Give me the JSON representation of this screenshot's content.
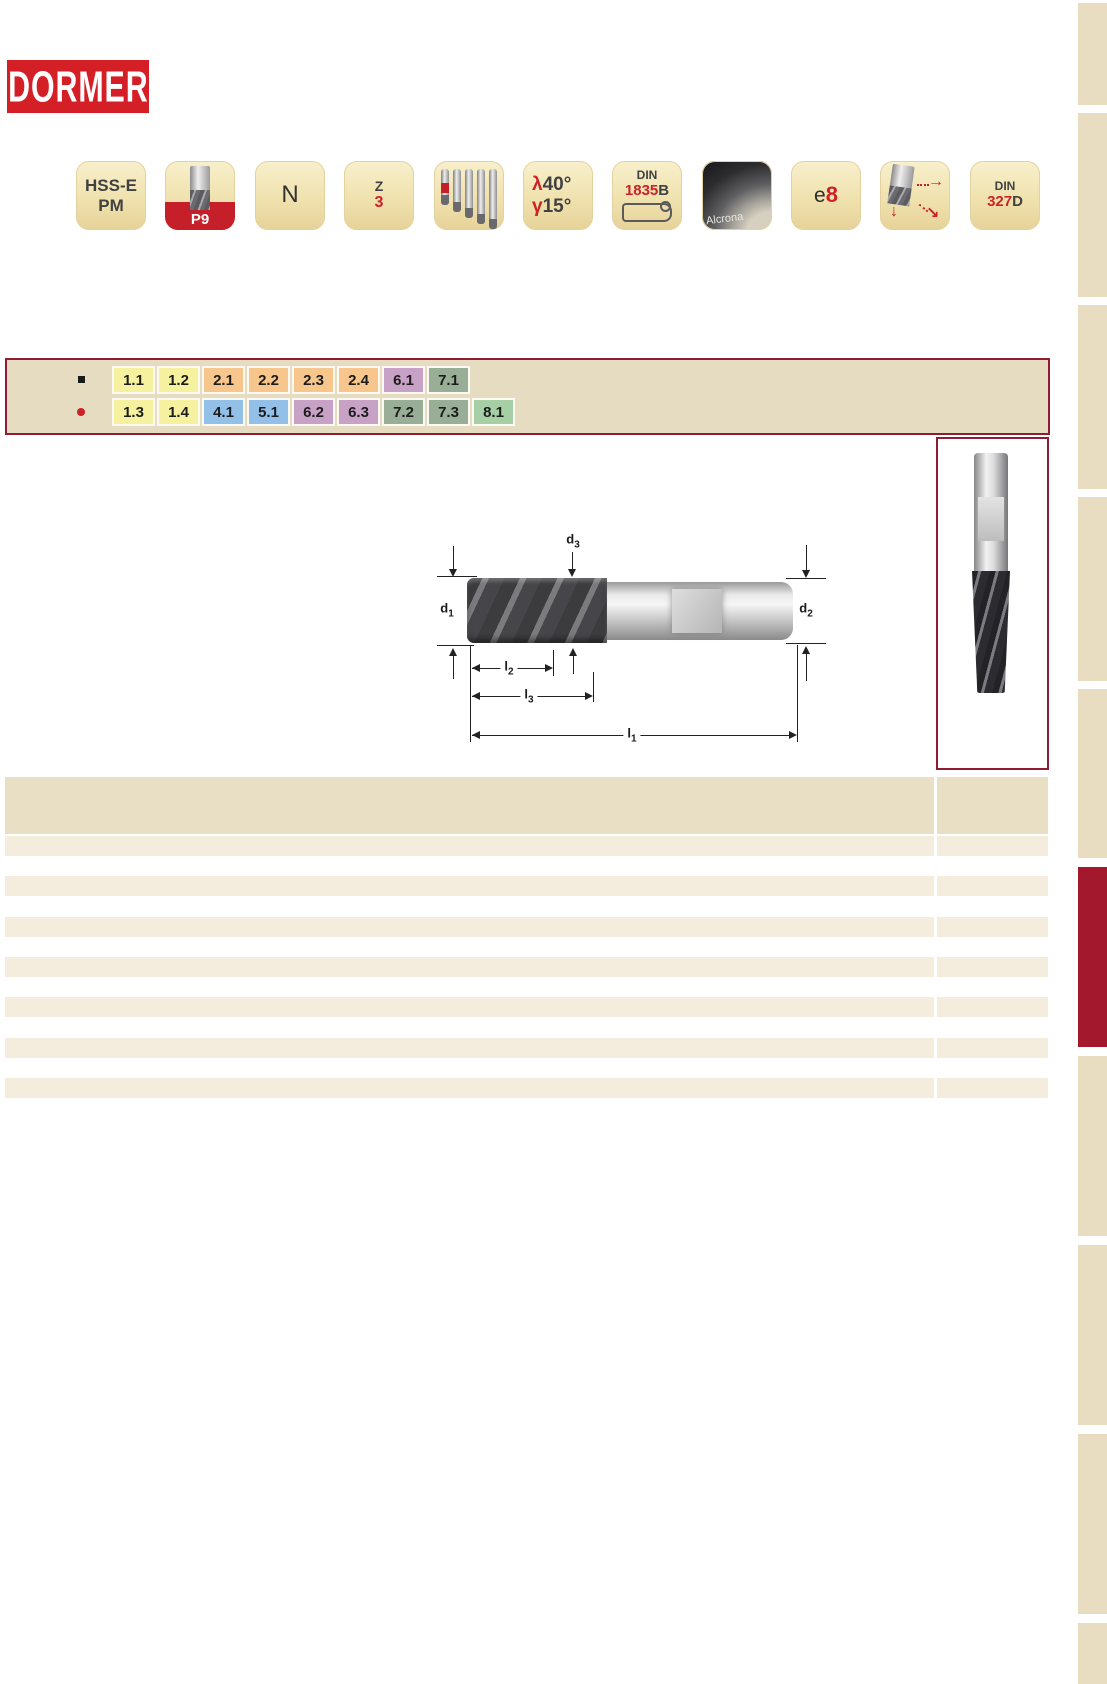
{
  "logo": {
    "text": "DORMER",
    "bg": "#d51f27",
    "fg": "#ffffff"
  },
  "badges": [
    {
      "name": "material-badge",
      "line1": "HSS-E",
      "line2": "PM"
    },
    {
      "name": "application-group-badge",
      "label": "P9"
    },
    {
      "name": "iso-material-badge",
      "label": "N"
    },
    {
      "name": "flute-count-badge",
      "symbol": "Z",
      "value": "3"
    },
    {
      "name": "product-range-badge"
    },
    {
      "name": "geometry-badge",
      "helix_symbol": "λ",
      "helix_value": "40°",
      "rake_symbol": "γ",
      "rake_value": "15°"
    },
    {
      "name": "shank-standard-badge",
      "std": "DIN",
      "num": "1835",
      "suffix": "B"
    },
    {
      "name": "coating-badge",
      "label": "Alcrona"
    },
    {
      "name": "tolerance-badge",
      "prefix": "e",
      "value": "8"
    },
    {
      "name": "ramping-badge",
      "arrow_right": "→",
      "arrow_down": "↓",
      "arrow_diag": "↘"
    },
    {
      "name": "standard-badge",
      "std": "DIN",
      "num": "327",
      "suffix": "D"
    }
  ],
  "codes": {
    "row1": {
      "bullet": "black-square",
      "items": [
        {
          "label": "1.1",
          "bg": "#f6f19e"
        },
        {
          "label": "1.2",
          "bg": "#f6f19e"
        },
        {
          "label": "2.1",
          "bg": "#f6c68c"
        },
        {
          "label": "2.2",
          "bg": "#f6c68c"
        },
        {
          "label": "2.3",
          "bg": "#f6c68c"
        },
        {
          "label": "2.4",
          "bg": "#f6c68c"
        },
        {
          "label": "6.1",
          "bg": "#c8a2c6"
        },
        {
          "label": "7.1",
          "bg": "#99ae97"
        }
      ]
    },
    "row2": {
      "bullet": "red-dot",
      "items": [
        {
          "label": "1.3",
          "bg": "#f6f19e"
        },
        {
          "label": "1.4",
          "bg": "#f6f19e"
        },
        {
          "label": "4.1",
          "bg": "#92c0e8"
        },
        {
          "label": "5.1",
          "bg": "#92c0e8"
        },
        {
          "label": "6.2",
          "bg": "#c8a2c6"
        },
        {
          "label": "6.3",
          "bg": "#c8a2c6"
        },
        {
          "label": "7.2",
          "bg": "#99ae97"
        },
        {
          "label": "7.3",
          "bg": "#99ae97"
        },
        {
          "label": "8.1",
          "bg": "#a6cfa6"
        }
      ]
    }
  },
  "diagram": {
    "d1": {
      "base": "d",
      "sub": "1"
    },
    "d2": {
      "base": "d",
      "sub": "2"
    },
    "d3": {
      "base": "d",
      "sub": "3"
    },
    "l1": {
      "base": "l",
      "sub": "1"
    },
    "l2": {
      "base": "l",
      "sub": "2"
    },
    "l3": {
      "base": "l",
      "sub": "3"
    }
  },
  "table": {
    "visible_empty_rows": 7
  },
  "sidebar": {
    "tab_count": 10,
    "highlighted_tab_index": 5
  },
  "colors": {
    "logo_red": "#d51f27",
    "accent_red": "#cc2127",
    "border_maroon": "#8e1c33",
    "tab_red": "#a4182d",
    "panel_tan": "#e6dcc2",
    "table_header": "#e9dfc5",
    "table_row": "#f4edde",
    "tab_beige": "#e8ddc1"
  }
}
